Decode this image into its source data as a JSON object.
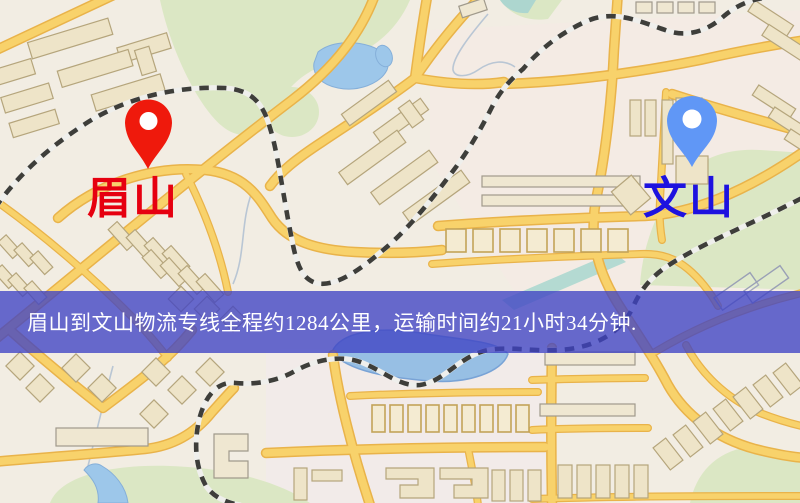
{
  "map": {
    "origin": {
      "name": "眉山",
      "pin_color": "#ea1a0e",
      "label_color": "#e60010"
    },
    "destination": {
      "name": "文山",
      "pin_color": "#6197f3",
      "label_color": "#1d12df"
    },
    "banner": {
      "text": "眉山到文山物流专线全程约1284公里，运输时间约21小时34分钟.",
      "text_color": "#ffffff",
      "background_color": "#3f42c4"
    }
  }
}
